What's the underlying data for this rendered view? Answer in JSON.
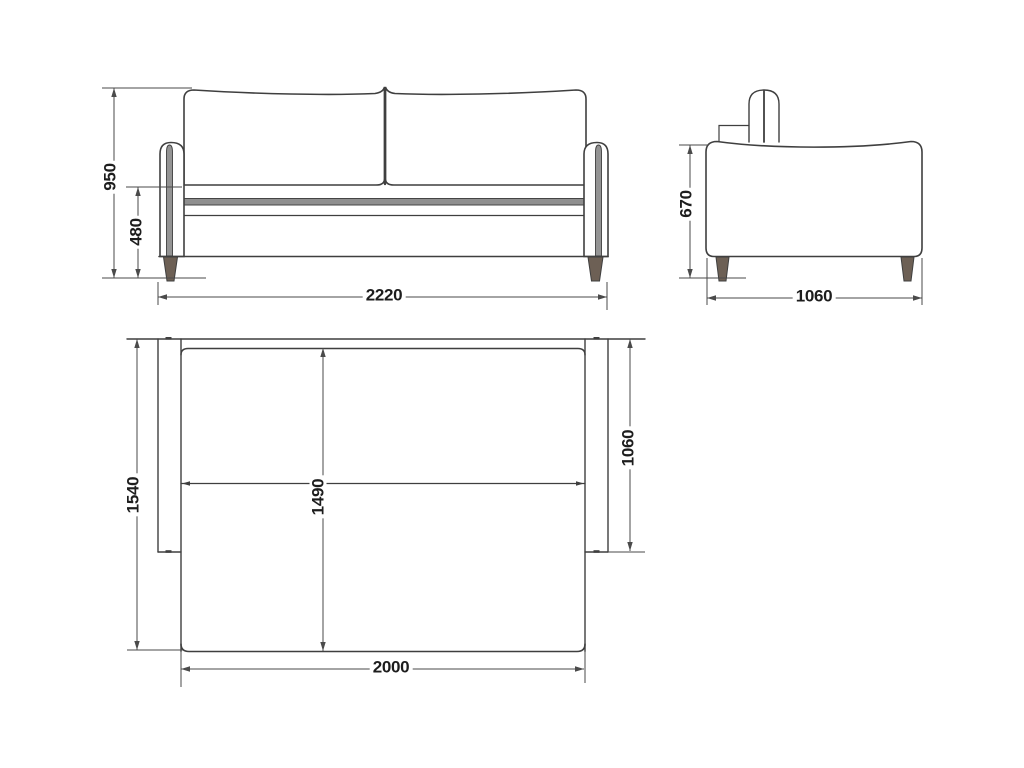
{
  "diagram": {
    "dimensions": {
      "front": {
        "overall_height": "950",
        "seat_height": "480",
        "overall_width": "2220"
      },
      "side": {
        "arm_height": "670",
        "overall_depth": "1060"
      },
      "top": {
        "overall_depth": "1540",
        "bed_length": "1490",
        "seat_depth": "1060",
        "bed_width": "2000"
      }
    },
    "colors": {
      "outline": "#3f3f3f",
      "dimension_line": "#4a4a4a",
      "label_text": "#1d1d1d",
      "leg_wood": "#6d6055",
      "upholstery_shadow": "#8f8f8f",
      "background": "#ffffff"
    }
  }
}
